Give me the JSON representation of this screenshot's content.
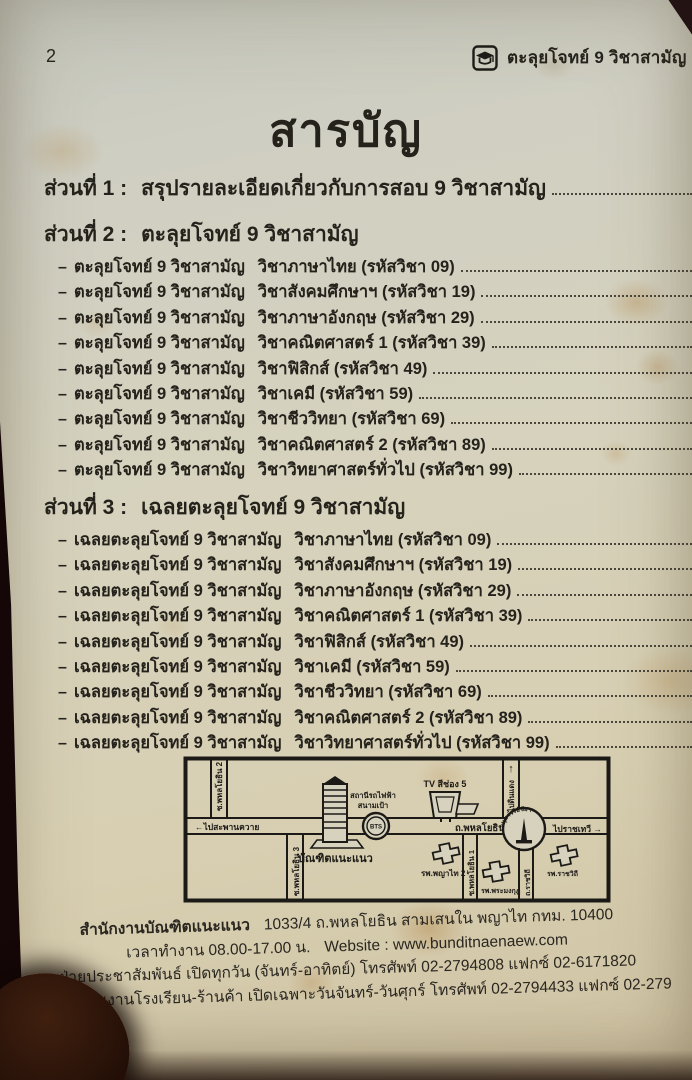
{
  "page": {
    "number": "2",
    "brand": "ตะลุยโจทย์ 9 วิชาสามัญ",
    "title": "สารบัญ"
  },
  "toc": {
    "dash": "–",
    "sections": [
      {
        "label": "ส่วนที่ 1 :",
        "title": "สรุปรายละเอียดเกี่ยวกับการสอบ 9 วิชาสามัญ",
        "items": []
      },
      {
        "label": "ส่วนที่ 2 :",
        "title": "ตะลุยโจทย์ 9 วิชาสามัญ",
        "items": [
          {
            "prefix": "ตะลุยโจทย์ 9 วิชาสามัญ",
            "subject": "วิชาภาษาไทย (รหัสวิชา 09)"
          },
          {
            "prefix": "ตะลุยโจทย์ 9 วิชาสามัญ",
            "subject": "วิชาสังคมศึกษาฯ (รหัสวิชา 19)"
          },
          {
            "prefix": "ตะลุยโจทย์ 9 วิชาสามัญ",
            "subject": "วิชาภาษาอังกฤษ (รหัสวิชา 29)"
          },
          {
            "prefix": "ตะลุยโจทย์ 9 วิชาสามัญ",
            "subject": "วิชาคณิตศาสตร์ 1 (รหัสวิชา 39)"
          },
          {
            "prefix": "ตะลุยโจทย์ 9 วิชาสามัญ",
            "subject": "วิชาฟิสิกส์ (รหัสวิชา 49)"
          },
          {
            "prefix": "ตะลุยโจทย์ 9 วิชาสามัญ",
            "subject": "วิชาเคมี (รหัสวิชา 59)"
          },
          {
            "prefix": "ตะลุยโจทย์ 9 วิชาสามัญ",
            "subject": "วิชาชีววิทยา (รหัสวิชา 69)"
          },
          {
            "prefix": "ตะลุยโจทย์ 9 วิชาสามัญ",
            "subject": "วิชาคณิตศาสตร์ 2 (รหัสวิชา 89)"
          },
          {
            "prefix": "ตะลุยโจทย์ 9 วิชาสามัญ",
            "subject": "วิชาวิทยาศาสตร์ทั่วไป (รหัสวิชา 99)"
          }
        ]
      },
      {
        "label": "ส่วนที่ 3 :",
        "title": "เฉลยตะลุยโจทย์ 9 วิชาสามัญ",
        "items": [
          {
            "prefix": "เฉลยตะลุยโจทย์ 9 วิชาสามัญ",
            "subject": "วิชาภาษาไทย (รหัสวิชา 09)"
          },
          {
            "prefix": "เฉลยตะลุยโจทย์ 9 วิชาสามัญ",
            "subject": "วิชาสังคมศึกษาฯ (รหัสวิชา 19)"
          },
          {
            "prefix": "เฉลยตะลุยโจทย์ 9 วิชาสามัญ",
            "subject": "วิชาภาษาอังกฤษ (รหัสวิชา 29)"
          },
          {
            "prefix": "เฉลยตะลุยโจทย์ 9 วิชาสามัญ",
            "subject": "วิชาคณิตศาสตร์ 1 (รหัสวิชา 39)"
          },
          {
            "prefix": "เฉลยตะลุยโจทย์ 9 วิชาสามัญ",
            "subject": "วิชาฟิสิกส์ (รหัสวิชา 49)"
          },
          {
            "prefix": "เฉลยตะลุยโจทย์ 9 วิชาสามัญ",
            "subject": "วิชาเคมี (รหัสวิชา 59)"
          },
          {
            "prefix": "เฉลยตะลุยโจทย์ 9 วิชาสามัญ",
            "subject": "วิชาชีววิทยา (รหัสวิชา 69)"
          },
          {
            "prefix": "เฉลยตะลุยโจทย์ 9 วิชาสามัญ",
            "subject": "วิชาคณิตศาสตร์ 2 (รหัสวิชา 89)"
          },
          {
            "prefix": "เฉลยตะลุยโจทย์ 9 วิชาสามัญ",
            "subject": "วิชาวิทยาศาสตร์ทั่วไป (รหัสวิชา 99)"
          }
        ]
      }
    ]
  },
  "map": {
    "labels": {
      "to_saphankhwai": "←ไปสะพานควาย",
      "soi2": "ซ.พหลโยธิน 2",
      "soi3": "ซ.พหลโยธิน 3",
      "soi1": "ซ.พหลโยธิน 1",
      "building": "บัณฑิตแนะแนว",
      "bts_line1": "สถานีรถไฟฟ้า",
      "bts_line2": "สนามเป้า",
      "bts": "BTS",
      "tv": "TV สีช่อง 5",
      "main_road": "ถ.พหลโยธิน",
      "arrow_up": "↑",
      "to_dindaeng": "ไปดินแดง",
      "monument": "อนุสาวรีย์ชัยฯ",
      "to_ratchathewi": "ไปราชเทวี →",
      "hosp_phyathai": "รพ.พญาไท 2",
      "hosp_phramongkut": "รพ.พระมงกุฎ",
      "road_ratchawithi": "ถ.ราชวิถี",
      "hosp_ratchawithi": "รพ.ราชวิถี"
    }
  },
  "footer": {
    "line1_name": "สำนักงานบัณฑิตแนะแนว",
    "line1_addr": "1033/4 ถ.พหลโยธิน สามเสนใน พญาไท กทม. 10400",
    "line2_hours": "เวลาทำงาน 08.00-17.00 น.",
    "line2_web": "Website : www.bunditnaenaew.com",
    "line3": "ฝ่ายประชาสัมพันธ์ เปิดทุกวัน (จันทร์-อาทิตย์) โทรศัพท์ 02-2794808 แฟกซ์ 02-6171820",
    "line4": "ฝ่ายประสานงานโรงเรียน-ร้านค้า เปิดเฉพาะวันจันทร์-วันศุกร์ โทรศัพท์ 02-2794433 แฟกซ์ 02-279"
  }
}
